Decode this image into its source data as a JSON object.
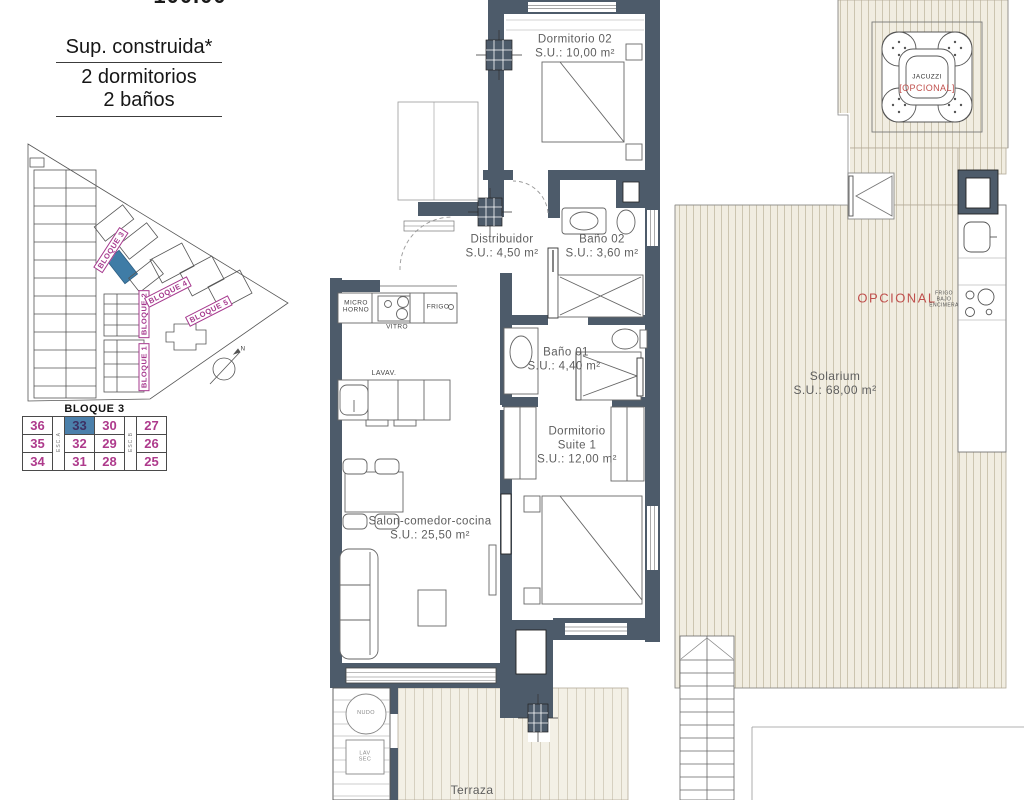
{
  "header": {
    "clipped_number": "100.00",
    "line1": "Sup. construida*",
    "line2": "2 dormitorios",
    "line3": "2 baños"
  },
  "site_plan": {
    "bloque1": "BLOQUE 1",
    "bloque2": "BLOQUE 2",
    "bloque3": "BLOQUE 3",
    "bloque4": "BLOQUE 4",
    "bloque5": "BLOQUE 5",
    "compass_letter": "N",
    "highlight_color": "#3f7ca6",
    "label_color": "#a6398e"
  },
  "unit_table": {
    "title": "BLOQUE 3",
    "esc_a": "ESC.A",
    "esc_b": "ESC.B",
    "selected_unit": "33",
    "selected_bg": "#4b80ab",
    "number_color": "#ae3a8c",
    "rows": [
      [
        "36",
        "33",
        "30",
        "27"
      ],
      [
        "35",
        "32",
        "29",
        "26"
      ],
      [
        "34",
        "31",
        "28",
        "25"
      ]
    ]
  },
  "rooms": {
    "dormitorio02": {
      "name": "Dormitorio 02",
      "area": "S.U.: 10,00 m²"
    },
    "distribuidor": {
      "name": "Distribuidor",
      "area": "S.U.: 4,50 m²"
    },
    "bano02": {
      "name": "Baño 02",
      "area": "S.U.: 3,60 m²"
    },
    "bano01": {
      "name": "Baño 01",
      "area": "S.U.: 4,40 m²"
    },
    "suite": {
      "name_line1": "Dormitorio",
      "name_line2": "Suite 1",
      "area": "S.U.: 12,00 m²"
    },
    "salon": {
      "name": "Salon-comedor-cocina",
      "area": "S.U.: 25,50 m²"
    },
    "solarium": {
      "name": "Solarium",
      "area": "S.U.: 68,00 m²"
    },
    "terraza": {
      "name": "Terraza"
    }
  },
  "kitchen": {
    "micro": "MICRO HORNO",
    "vitro": "VITRO",
    "frigo": "FRIGO",
    "lavav": "LAVAV."
  },
  "utility": {
    "circle_label": "NUDO",
    "box_label": "LAV SEC"
  },
  "outdoor": {
    "opcional": "OPCIONAL",
    "opcional_color": "#c0504d",
    "frigo_bajo": "FRIGO BAJO ENCIMERA",
    "jacuzzi": "JACUZZI",
    "jacuzzi_opcional": "[OPCIONAL]"
  }
}
